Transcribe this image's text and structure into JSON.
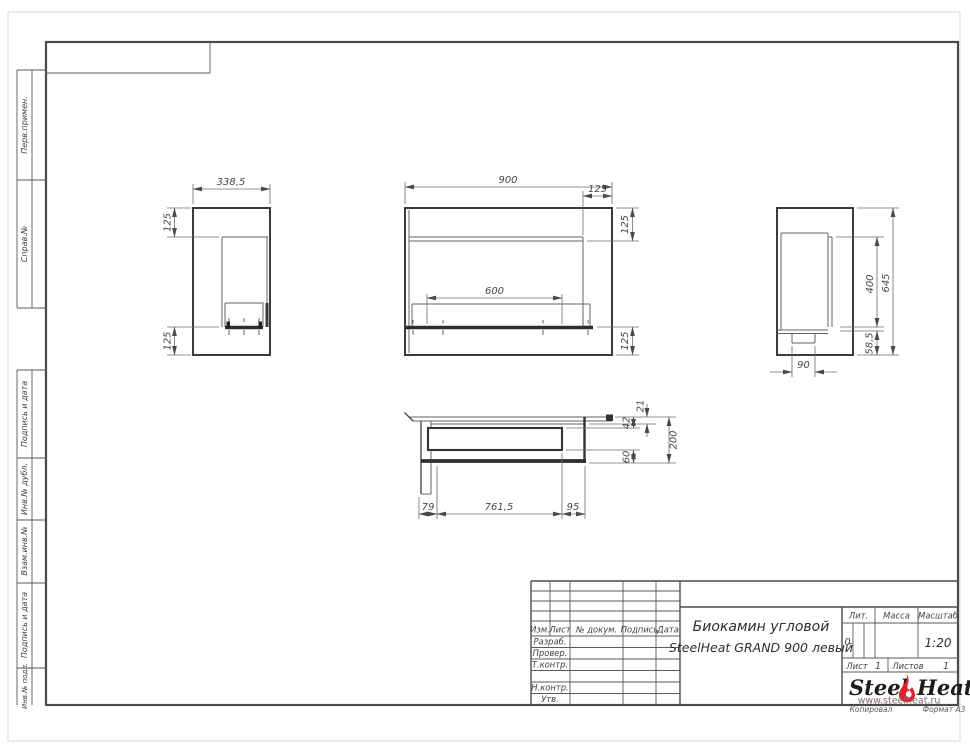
{
  "colors": {
    "line": "#4a4a4a",
    "flame_red": "#e31e24",
    "paper": "#ffffff"
  },
  "margin_labels": [
    "Перв.примен.",
    "Справ.№",
    "Подпись и дата",
    "Инв.№ дубл.",
    "Взам.инв.№",
    "Подпись и дата",
    "Инв.№ подл."
  ],
  "footer": {
    "copied": "Копировал",
    "format": "Формат А3"
  },
  "title_block": {
    "cols": {
      "izm": "Изм.",
      "list": "Лист",
      "doc": "№ докум.",
      "sign": "Подпись",
      "date": "Дата"
    },
    "rows": {
      "razrab": "Разраб.",
      "prover": "Провер.",
      "tkontr": "Т.контр.",
      "nkontr": "Н.контр.",
      "utv": "Утв."
    },
    "title_line1": "Биокамин угловой",
    "title_line2": "SteelHeat GRAND 900 левый",
    "lit_label": "Лит.",
    "lit_value": "0",
    "mass_label": "Масса",
    "mass_value": "",
    "scale_label": "Масштаб",
    "scale_value": "1:20",
    "sheet_label": "Лист",
    "sheet_value": "1",
    "sheets_label": "Листов",
    "sheets_value": "1",
    "logo_steel": "Steel",
    "logo_heat": "Heat",
    "logo_url": "www.steelheat.ru"
  },
  "dims": {
    "side_width": "338,5",
    "side_top": "125",
    "side_bottom": "125",
    "front_width": "900",
    "front_right": "125",
    "front_top": "125",
    "front_burner": "600",
    "front_bottom": "125",
    "profile_opening": "400",
    "profile_height": "645",
    "profile_bottom": "58,5",
    "profile_foot": "90",
    "plan_lip": "21",
    "plan_front": "42",
    "plan_back": "60",
    "plan_depth": "200",
    "plan_left": "79",
    "plan_length": "761,5",
    "plan_right": "95"
  }
}
